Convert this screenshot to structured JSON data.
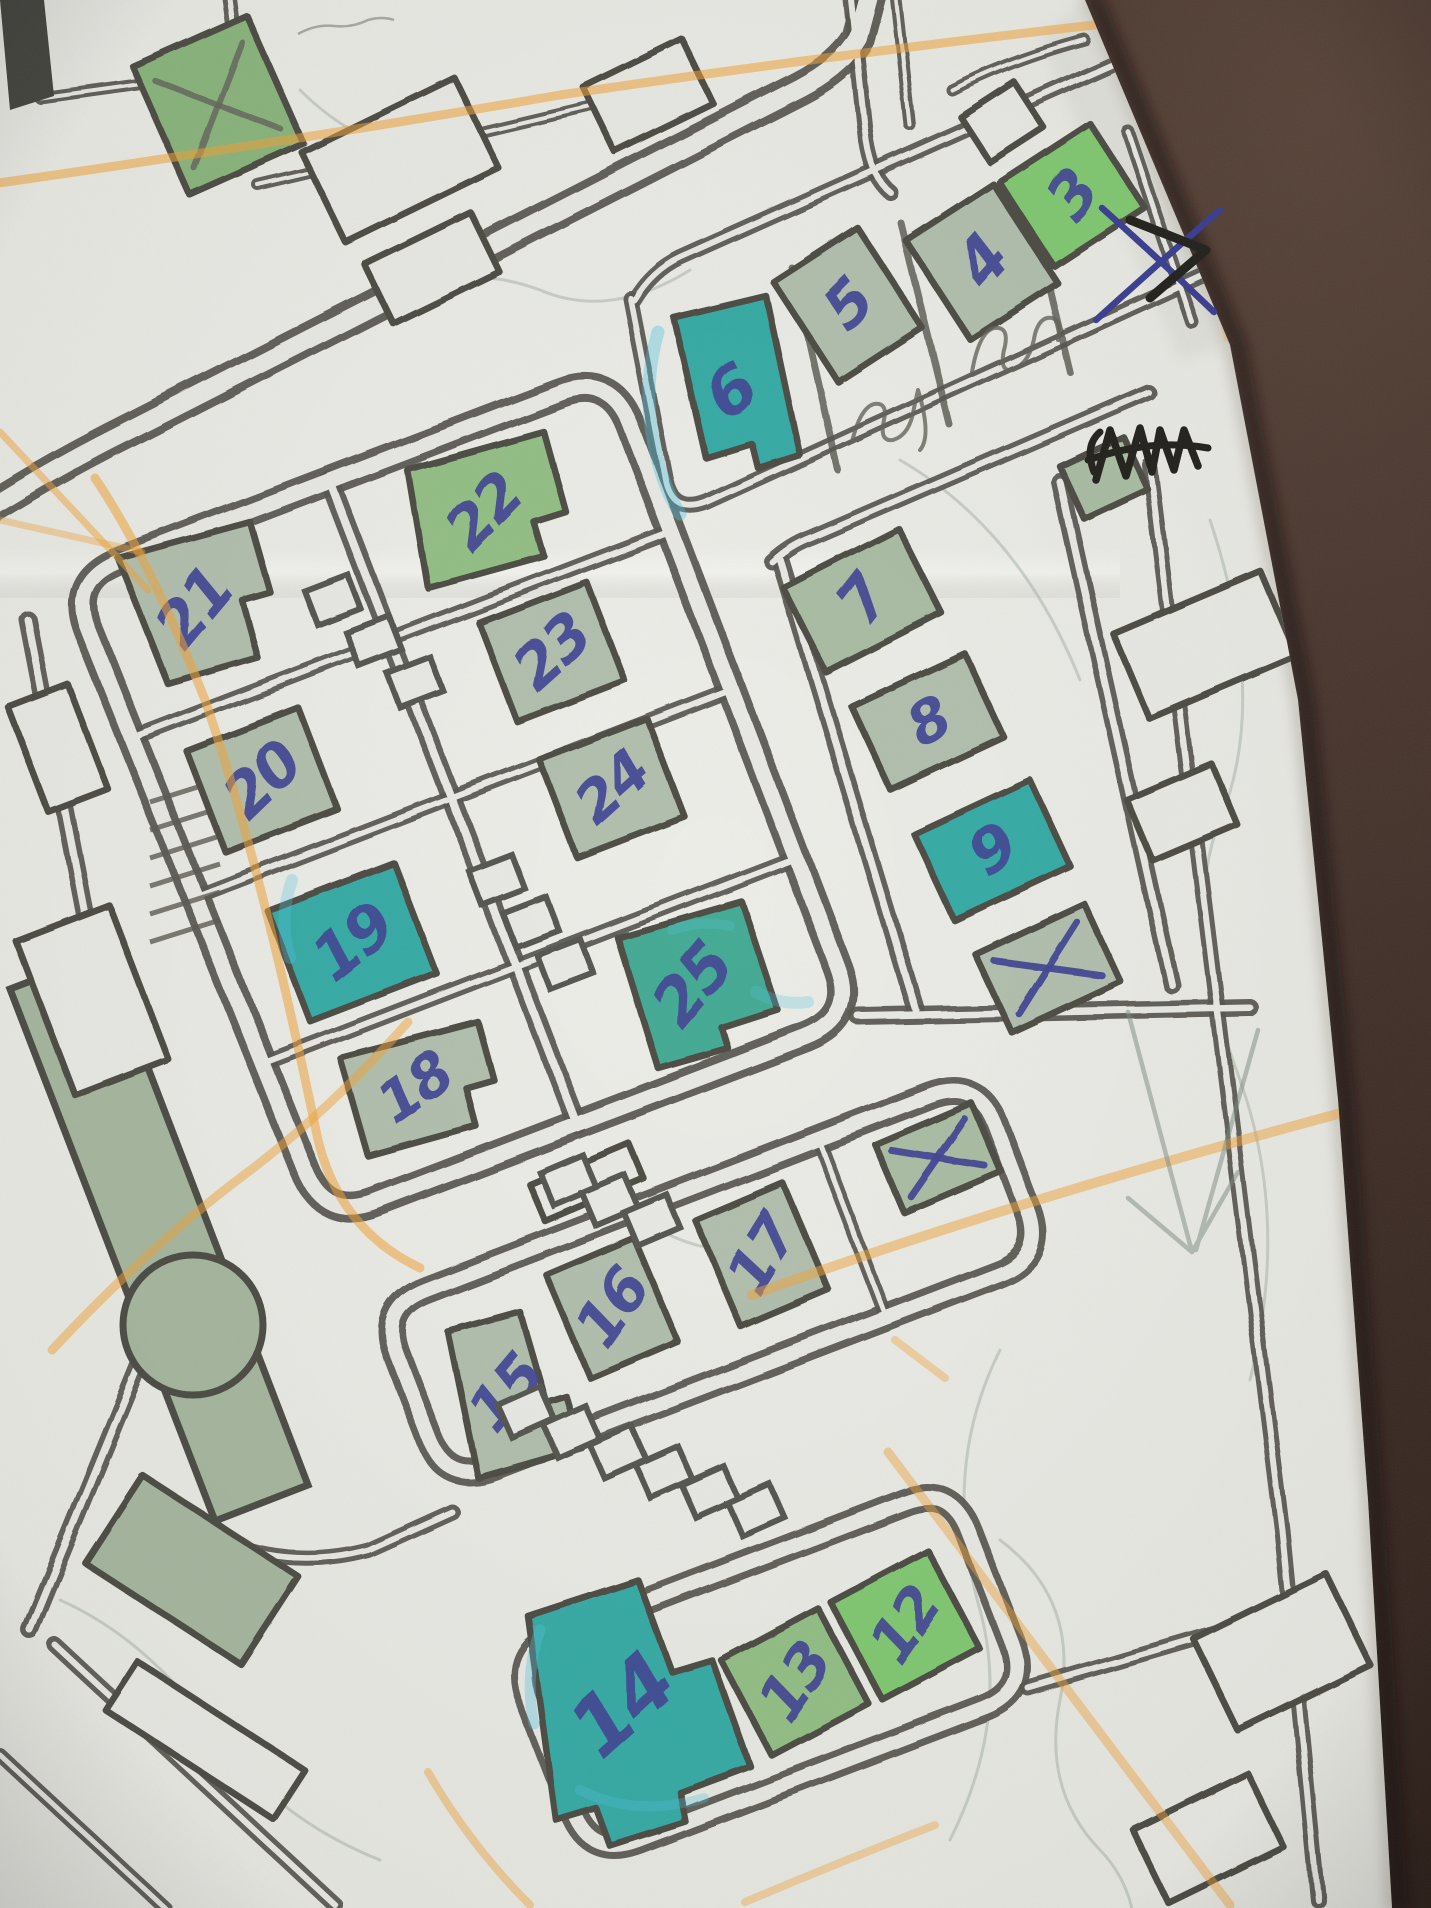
{
  "scene": {
    "description": "Photograph of a printed street map on a dark brown table, hand-annotated with numbered buildings, pen crosses and highlighter route lines",
    "table_color": "#34251d",
    "paper_color": "#e9e9e4"
  },
  "palette": {
    "fills": {
      "bright": "#7bc76c",
      "mid": "#8fbd80",
      "mid2": "#85b277",
      "pale": "#afbdaa",
      "pale2": "#a6bba0",
      "teal": "#2fa8a2",
      "tealgreen": "#3aa78f",
      "park": "#a3b49b",
      "paper": "#e9e9e4"
    },
    "ink": {
      "street": "#504f48",
      "building_stroke": "#45453e",
      "pen_blue": "#3a3e90",
      "marker_black": "#23211c",
      "pencil": "#5c5c54",
      "pencil_light": "#8a9a8c",
      "highlight_orange": "#f0a030",
      "highlight_cyan": "#4ac3e0"
    }
  },
  "map": {
    "numbered_buildings": [
      {
        "id": "b3",
        "label": "3",
        "fill": "bright",
        "cx": 1072,
        "cy": 195,
        "w": 108,
        "h": 100,
        "rot": -33,
        "lrot": -52,
        "ls": 62
      },
      {
        "id": "b4",
        "label": "4",
        "fill": "pale",
        "cx": 982,
        "cy": 262,
        "w": 104,
        "h": 118,
        "rot": -33,
        "lrot": -48,
        "ls": 62
      },
      {
        "id": "b5",
        "label": "5",
        "fill": "pale",
        "cx": 848,
        "cy": 305,
        "w": 100,
        "h": 120,
        "rot": -33,
        "lrot": -45,
        "ls": 62
      },
      {
        "id": "b6",
        "label": "6",
        "fill": "teal",
        "path": "M674,318 L766,296 L800,455 L758,468 L752,444 L706,458 Z",
        "cx": 730,
        "cy": 392,
        "w": 112,
        "h": 160,
        "rot": -30,
        "lrot": -38,
        "ls": 66
      },
      {
        "id": "b7",
        "label": "7",
        "fill": "pale2",
        "cx": 862,
        "cy": 600,
        "w": 130,
        "h": 95,
        "rot": -27,
        "lrot": -52,
        "ls": 60
      },
      {
        "id": "b8",
        "label": "8",
        "fill": "pale",
        "cx": 928,
        "cy": 722,
        "w": 125,
        "h": 92,
        "rot": -25,
        "lrot": -28,
        "ls": 58
      },
      {
        "id": "b9",
        "label": "9",
        "fill": "teal",
        "cx": 992,
        "cy": 850,
        "w": 128,
        "h": 95,
        "rot": -25,
        "lrot": -35,
        "ls": 62
      },
      {
        "id": "bx9",
        "label": "",
        "fill": "pale",
        "cx": 1048,
        "cy": 968,
        "w": 120,
        "h": 86,
        "rot": -25,
        "mark": "blue-x"
      },
      {
        "id": "b21",
        "label": "21",
        "fill": "pale",
        "path": "M118,558 L250,522 L270,592 L242,600 L258,658 L168,684 Z",
        "cx": 194,
        "cy": 608,
        "w": 150,
        "h": 130,
        "rot": -21,
        "lrot": -50,
        "ls": 62
      },
      {
        "id": "b22",
        "label": "22",
        "fill": "mid",
        "path": "M408,470 L544,432 L566,512 L534,522 L544,556 L428,588 Z",
        "cx": 484,
        "cy": 512,
        "w": 150,
        "h": 118,
        "rot": -21,
        "lrot": -46,
        "ls": 60
      },
      {
        "id": "b23",
        "label": "23",
        "fill": "pale",
        "cx": 552,
        "cy": 652,
        "w": 115,
        "h": 105,
        "rot": -21,
        "lrot": -42,
        "ls": 60
      },
      {
        "id": "b20",
        "label": "20",
        "fill": "pale",
        "cx": 262,
        "cy": 780,
        "w": 120,
        "h": 108,
        "rot": -21,
        "lrot": -44,
        "ls": 60
      },
      {
        "id": "b24",
        "label": "24",
        "fill": "pale",
        "cx": 612,
        "cy": 788,
        "w": 115,
        "h": 105,
        "rot": -21,
        "lrot": -42,
        "ls": 58
      },
      {
        "id": "b19",
        "label": "19",
        "fill": "teal",
        "cx": 352,
        "cy": 942,
        "w": 135,
        "h": 118,
        "rot": -21,
        "lrot": -38,
        "ls": 62
      },
      {
        "id": "b25",
        "label": "25",
        "fill": "tealgreen",
        "path": "M618,938 L742,902 L778,1010 L722,1028 L728,1048 L658,1068 Z",
        "cx": 692,
        "cy": 985,
        "w": 150,
        "h": 115,
        "rot": -21,
        "lrot": -50,
        "ls": 64
      },
      {
        "id": "b18",
        "label": "18",
        "fill": "pale",
        "path": "M340,1058 L478,1022 L494,1080 L466,1088 L476,1126 L368,1156 Z",
        "cx": 414,
        "cy": 1088,
        "w": 165,
        "h": 100,
        "rot": -21,
        "lrot": -35,
        "ls": 58
      },
      {
        "id": "bx17",
        "label": "",
        "fill": "pale2",
        "cx": 938,
        "cy": 1158,
        "w": 105,
        "h": 74,
        "rot": -23,
        "mark": "blue-x"
      },
      {
        "id": "b17",
        "label": "17",
        "fill": "pale",
        "cx": 762,
        "cy": 1255,
        "w": 95,
        "h": 115,
        "rot": -23,
        "lrot": -58,
        "ls": 60
      },
      {
        "id": "b16",
        "label": "16",
        "fill": "pale",
        "cx": 612,
        "cy": 1308,
        "w": 95,
        "h": 112,
        "rot": -23,
        "lrot": -55,
        "ls": 60
      },
      {
        "id": "b15",
        "label": "15",
        "fill": "pale",
        "path": "M448,1332 L520,1312 L546,1402 L566,1396 L582,1448 L478,1478 Z",
        "cx": 505,
        "cy": 1393,
        "w": 110,
        "h": 140,
        "rot": -23,
        "lrot": -50,
        "ls": 60
      },
      {
        "id": "b14",
        "label": "14",
        "fill": "teal",
        "path": "M528,1616 L638,1580 L672,1672 L712,1660 L750,1766 L680,1792 L686,1822 L610,1846 L596,1808 L556,1820 Z",
        "cx": 622,
        "cy": 1706,
        "w": 195,
        "h": 190,
        "rot": -24,
        "lrot": -42,
        "ls": 80
      },
      {
        "id": "b13",
        "label": "13",
        "fill": "mid",
        "cx": 795,
        "cy": 1682,
        "w": 110,
        "h": 108,
        "rot": -28,
        "lrot": -55,
        "ls": 60
      },
      {
        "id": "b12",
        "label": "12",
        "fill": "bright",
        "cx": 905,
        "cy": 1625,
        "w": 110,
        "h": 110,
        "rot": -28,
        "lrot": -55,
        "ls": 58
      },
      {
        "id": "bxTL",
        "label": "",
        "fill": "mid2",
        "cx": 218,
        "cy": 105,
        "w": 125,
        "h": 140,
        "rot": -24,
        "mark": "pencil-x"
      },
      {
        "id": "w1",
        "label": "",
        "fill": "paper",
        "cx": 400,
        "cy": 160,
        "w": 170,
        "h": 100,
        "rot": -26
      },
      {
        "id": "w2",
        "label": "",
        "fill": "paper",
        "cx": 432,
        "cy": 268,
        "w": 118,
        "h": 66,
        "rot": -26
      },
      {
        "id": "w3",
        "label": "",
        "fill": "paper",
        "cx": 648,
        "cy": 95,
        "w": 110,
        "h": 72,
        "rot": -26
      },
      {
        "id": "w4",
        "label": "",
        "fill": "paper",
        "cx": 1002,
        "cy": 122,
        "w": 64,
        "h": 54,
        "rot": -33
      },
      {
        "id": "w5",
        "label": "",
        "fill": "paper",
        "cx": 1205,
        "cy": 645,
        "w": 160,
        "h": 92,
        "rot": -23
      },
      {
        "id": "w6",
        "label": "",
        "fill": "paper",
        "cx": 1182,
        "cy": 812,
        "w": 92,
        "h": 66,
        "rot": -23
      },
      {
        "id": "w7",
        "label": "",
        "fill": "paper",
        "cx": 1282,
        "cy": 1652,
        "w": 148,
        "h": 102,
        "rot": -26
      },
      {
        "id": "w8",
        "label": "",
        "fill": "paper",
        "cx": 1208,
        "cy": 1838,
        "w": 128,
        "h": 82,
        "rot": -26
      },
      {
        "id": "w9",
        "label": "",
        "fill": "paper",
        "cx": 92,
        "cy": 1000,
        "w": 100,
        "h": 165,
        "rot": -21
      },
      {
        "id": "w10",
        "label": "",
        "fill": "paper",
        "cx": 58,
        "cy": 748,
        "w": 64,
        "h": 112,
        "rot": -21
      },
      {
        "id": "w11",
        "label": "",
        "fill": "paper",
        "cx": 562,
        "cy": 1192,
        "w": 54,
        "h": 40,
        "rot": -23
      },
      {
        "id": "w12",
        "label": "",
        "fill": "paper",
        "cx": 614,
        "cy": 1170,
        "w": 48,
        "h": 38,
        "rot": -23
      },
      {
        "id": "w13",
        "label": "",
        "fill": "pale2",
        "cx": 1104,
        "cy": 478,
        "w": 70,
        "h": 58,
        "rot": -25
      },
      {
        "id": "g1",
        "label": "",
        "fill": "park",
        "cx": 192,
        "cy": 1570,
        "w": 185,
        "h": 105,
        "rot": 33
      },
      {
        "id": "g2",
        "label": "",
        "fill": "paper",
        "cx": 205,
        "cy": 1740,
        "w": 200,
        "h": 58,
        "rot": 33
      }
    ],
    "garage_chains": [
      {
        "x": 333,
        "y": 600,
        "rot": -21
      },
      {
        "x": 374,
        "y": 641,
        "rot": -21
      },
      {
        "x": 415,
        "y": 682,
        "rot": -21
      },
      {
        "x": 497,
        "y": 880,
        "rot": -21
      },
      {
        "x": 531,
        "y": 922,
        "rot": -21
      },
      {
        "x": 565,
        "y": 964,
        "rot": -21
      },
      {
        "x": 526,
        "y": 1412,
        "rot": -24
      },
      {
        "x": 572,
        "y": 1432,
        "rot": -24
      },
      {
        "x": 618,
        "y": 1452,
        "rot": -24
      },
      {
        "x": 664,
        "y": 1472,
        "rot": -24
      },
      {
        "x": 710,
        "y": 1492,
        "rot": -24
      },
      {
        "x": 756,
        "y": 1510,
        "rot": -24
      },
      {
        "x": 568,
        "y": 1180,
        "rot": -23
      },
      {
        "x": 610,
        "y": 1200,
        "rot": -23
      },
      {
        "x": 652,
        "y": 1220,
        "rot": -23
      }
    ],
    "crossed_out_buildings": 4,
    "notes": "numbers 3-9 and 12-25 visible; 6,9,19,25,14 teal; 3,12 bright green; top-right pen X; black marker scribble; pencil scribbles near 4 and 5; orange highlighter route lines; park with circular plaza"
  }
}
